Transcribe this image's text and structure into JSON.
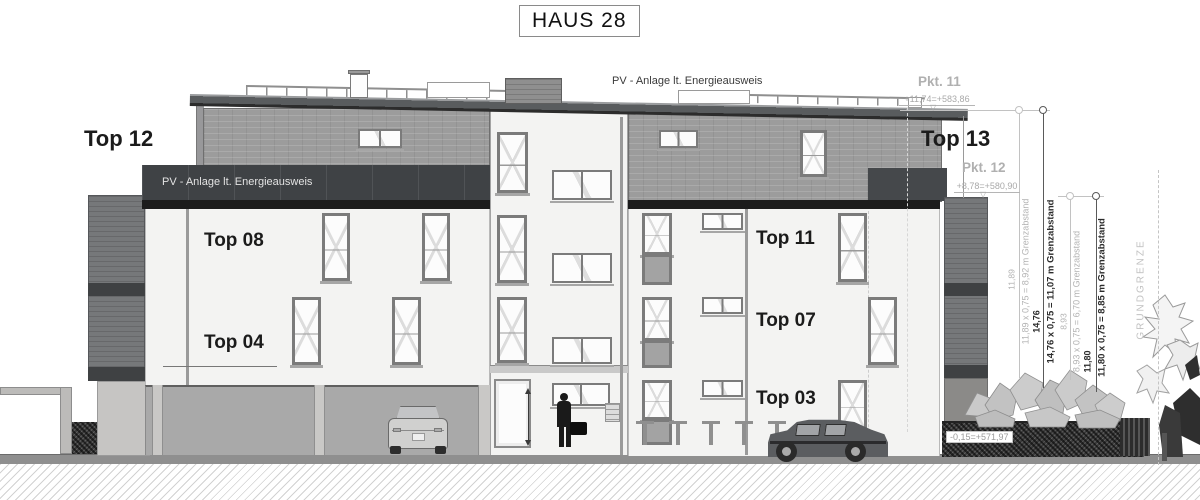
{
  "title": "HAUS 28",
  "pv_note": "PV - Anlage lt. Energieausweis",
  "units": {
    "top12": "Top 12",
    "top13": "Top 13",
    "top08": "Top 08",
    "top04": "Top 04",
    "top11": "Top 11",
    "top07": "Top 07",
    "top03": "Top 03"
  },
  "survey": {
    "pkt11": {
      "name": "Pkt. 11",
      "elevation": "+11,74=+583,86"
    },
    "pkt12": {
      "name": "Pkt. 12",
      "elevation": "+8,78=+580,90"
    },
    "ground": {
      "elevation": "-0,15=+571,97"
    },
    "marker_glyph": "▽"
  },
  "distances": [
    {
      "length": "11,89",
      "formula": "11,89 x 0,75 = 8,92 m Grenzabstand"
    },
    {
      "length": "14,76",
      "formula": "14,76 x 0,75 = 11,07 m Grenzabstand"
    },
    {
      "length": "8,93",
      "formula": "8,93 x 0,75 = 6,70 m Grenzabstand"
    },
    {
      "length": "11,80",
      "formula": "11,80 x 0,75 = 8,85 m Grenzabstand"
    }
  ],
  "boundary": {
    "label": "GRUNDGRENZE"
  },
  "colors": {
    "facade_white": "#f3f3f2",
    "brick_gray": "#9c9c9c",
    "band_dark": "#3f4245",
    "ground_gray": "#8f8f8f"
  }
}
